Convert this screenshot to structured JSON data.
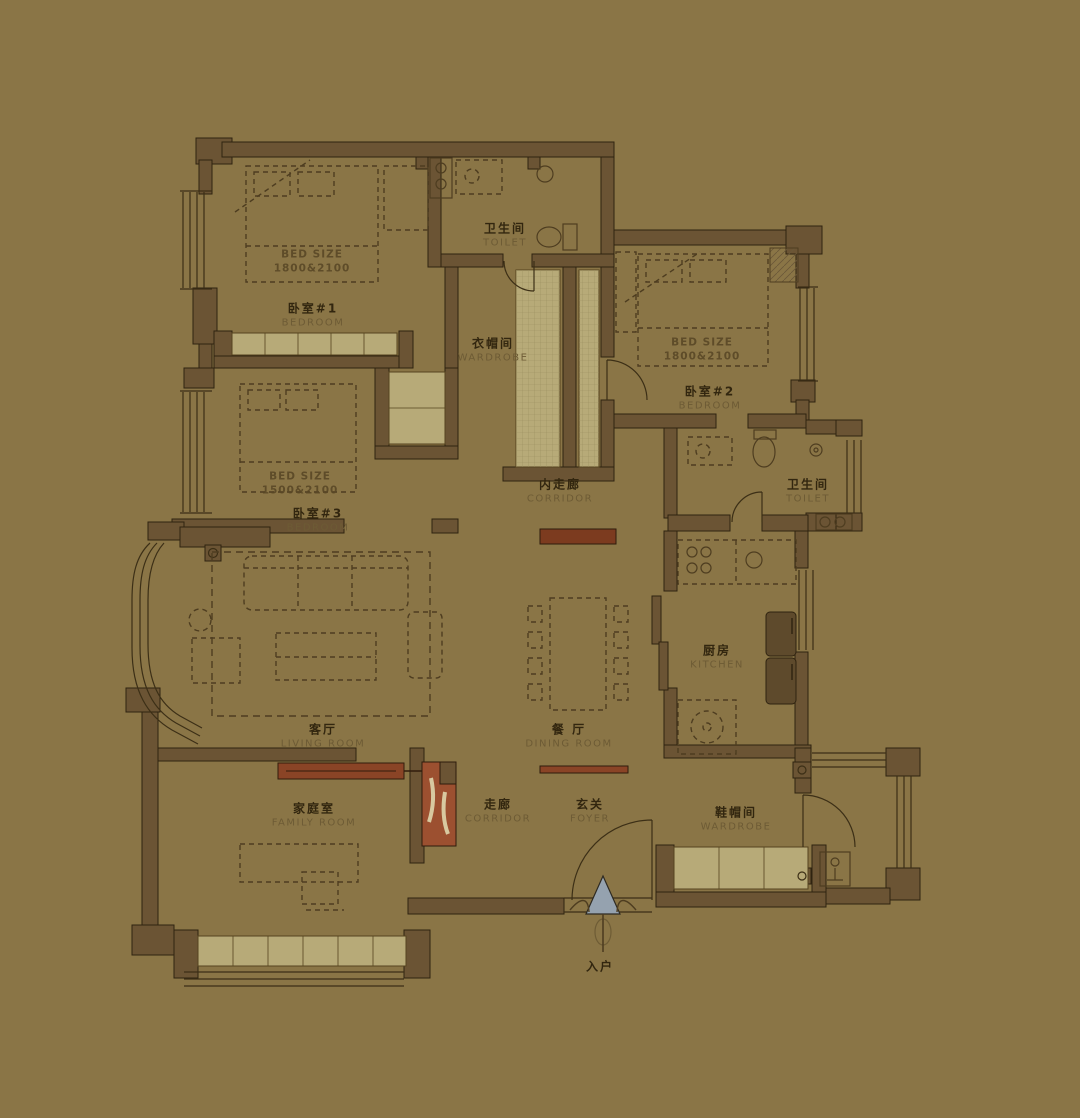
{
  "title": "apartment-floor-plan",
  "colors": {
    "bg": "#8a7546",
    "wall": "#6b5434",
    "wall_stroke": "#2f2310",
    "line": "#4e3d20",
    "thin": "#3c2f16",
    "cab": "#b7aa78",
    "cab_line": "#55431f",
    "grid": "#9a8d5e",
    "red": "#8a4426",
    "red_dark": "#7c3b1f",
    "red_light": "#9c5030",
    "cream": "#d8c9a0",
    "arrow": "#95a2af",
    "zh": "#32260f",
    "en": "#6d5b35",
    "size": "#5a4826"
  },
  "rooms": [
    {
      "id": "bedroom1",
      "zh": "卧室#1",
      "en": "BEDROOM"
    },
    {
      "id": "toilet1",
      "zh": "卫生间",
      "en": "TOILET"
    },
    {
      "id": "wardrobe1",
      "zh": "衣帽间",
      "en": "WARDROBE"
    },
    {
      "id": "bedroom2",
      "zh": "卧室#2",
      "en": "BEDROOM"
    },
    {
      "id": "bedroom3",
      "zh": "卧室#3",
      "en": "BEDROOM"
    },
    {
      "id": "inner_corridor",
      "zh": "内走廊",
      "en": "CORRIDOR"
    },
    {
      "id": "toilet2",
      "zh": "卫生间",
      "en": "TOILET"
    },
    {
      "id": "kitchen",
      "zh": "厨房",
      "en": "KITCHEN"
    },
    {
      "id": "living_room",
      "zh": "客厅",
      "en": "LIVING ROOM"
    },
    {
      "id": "dining_room",
      "zh": "餐 厅",
      "en": "DINING ROOM"
    },
    {
      "id": "family_room",
      "zh": "家庭室",
      "en": "FAMILY ROOM"
    },
    {
      "id": "corridor",
      "zh": "走廊",
      "en": "CORRIDOR"
    },
    {
      "id": "foyer",
      "zh": "玄关",
      "en": "FOYER"
    },
    {
      "id": "shoe_wardrobe",
      "zh": "鞋帽间",
      "en": "WARDROBE"
    }
  ],
  "annotations": {
    "bed_size_label": "BED SIZE",
    "bed1_size": "1800&2100",
    "bed2_size": "1800&2100",
    "bed3_size": "1500&2100",
    "entrance": "入户"
  }
}
